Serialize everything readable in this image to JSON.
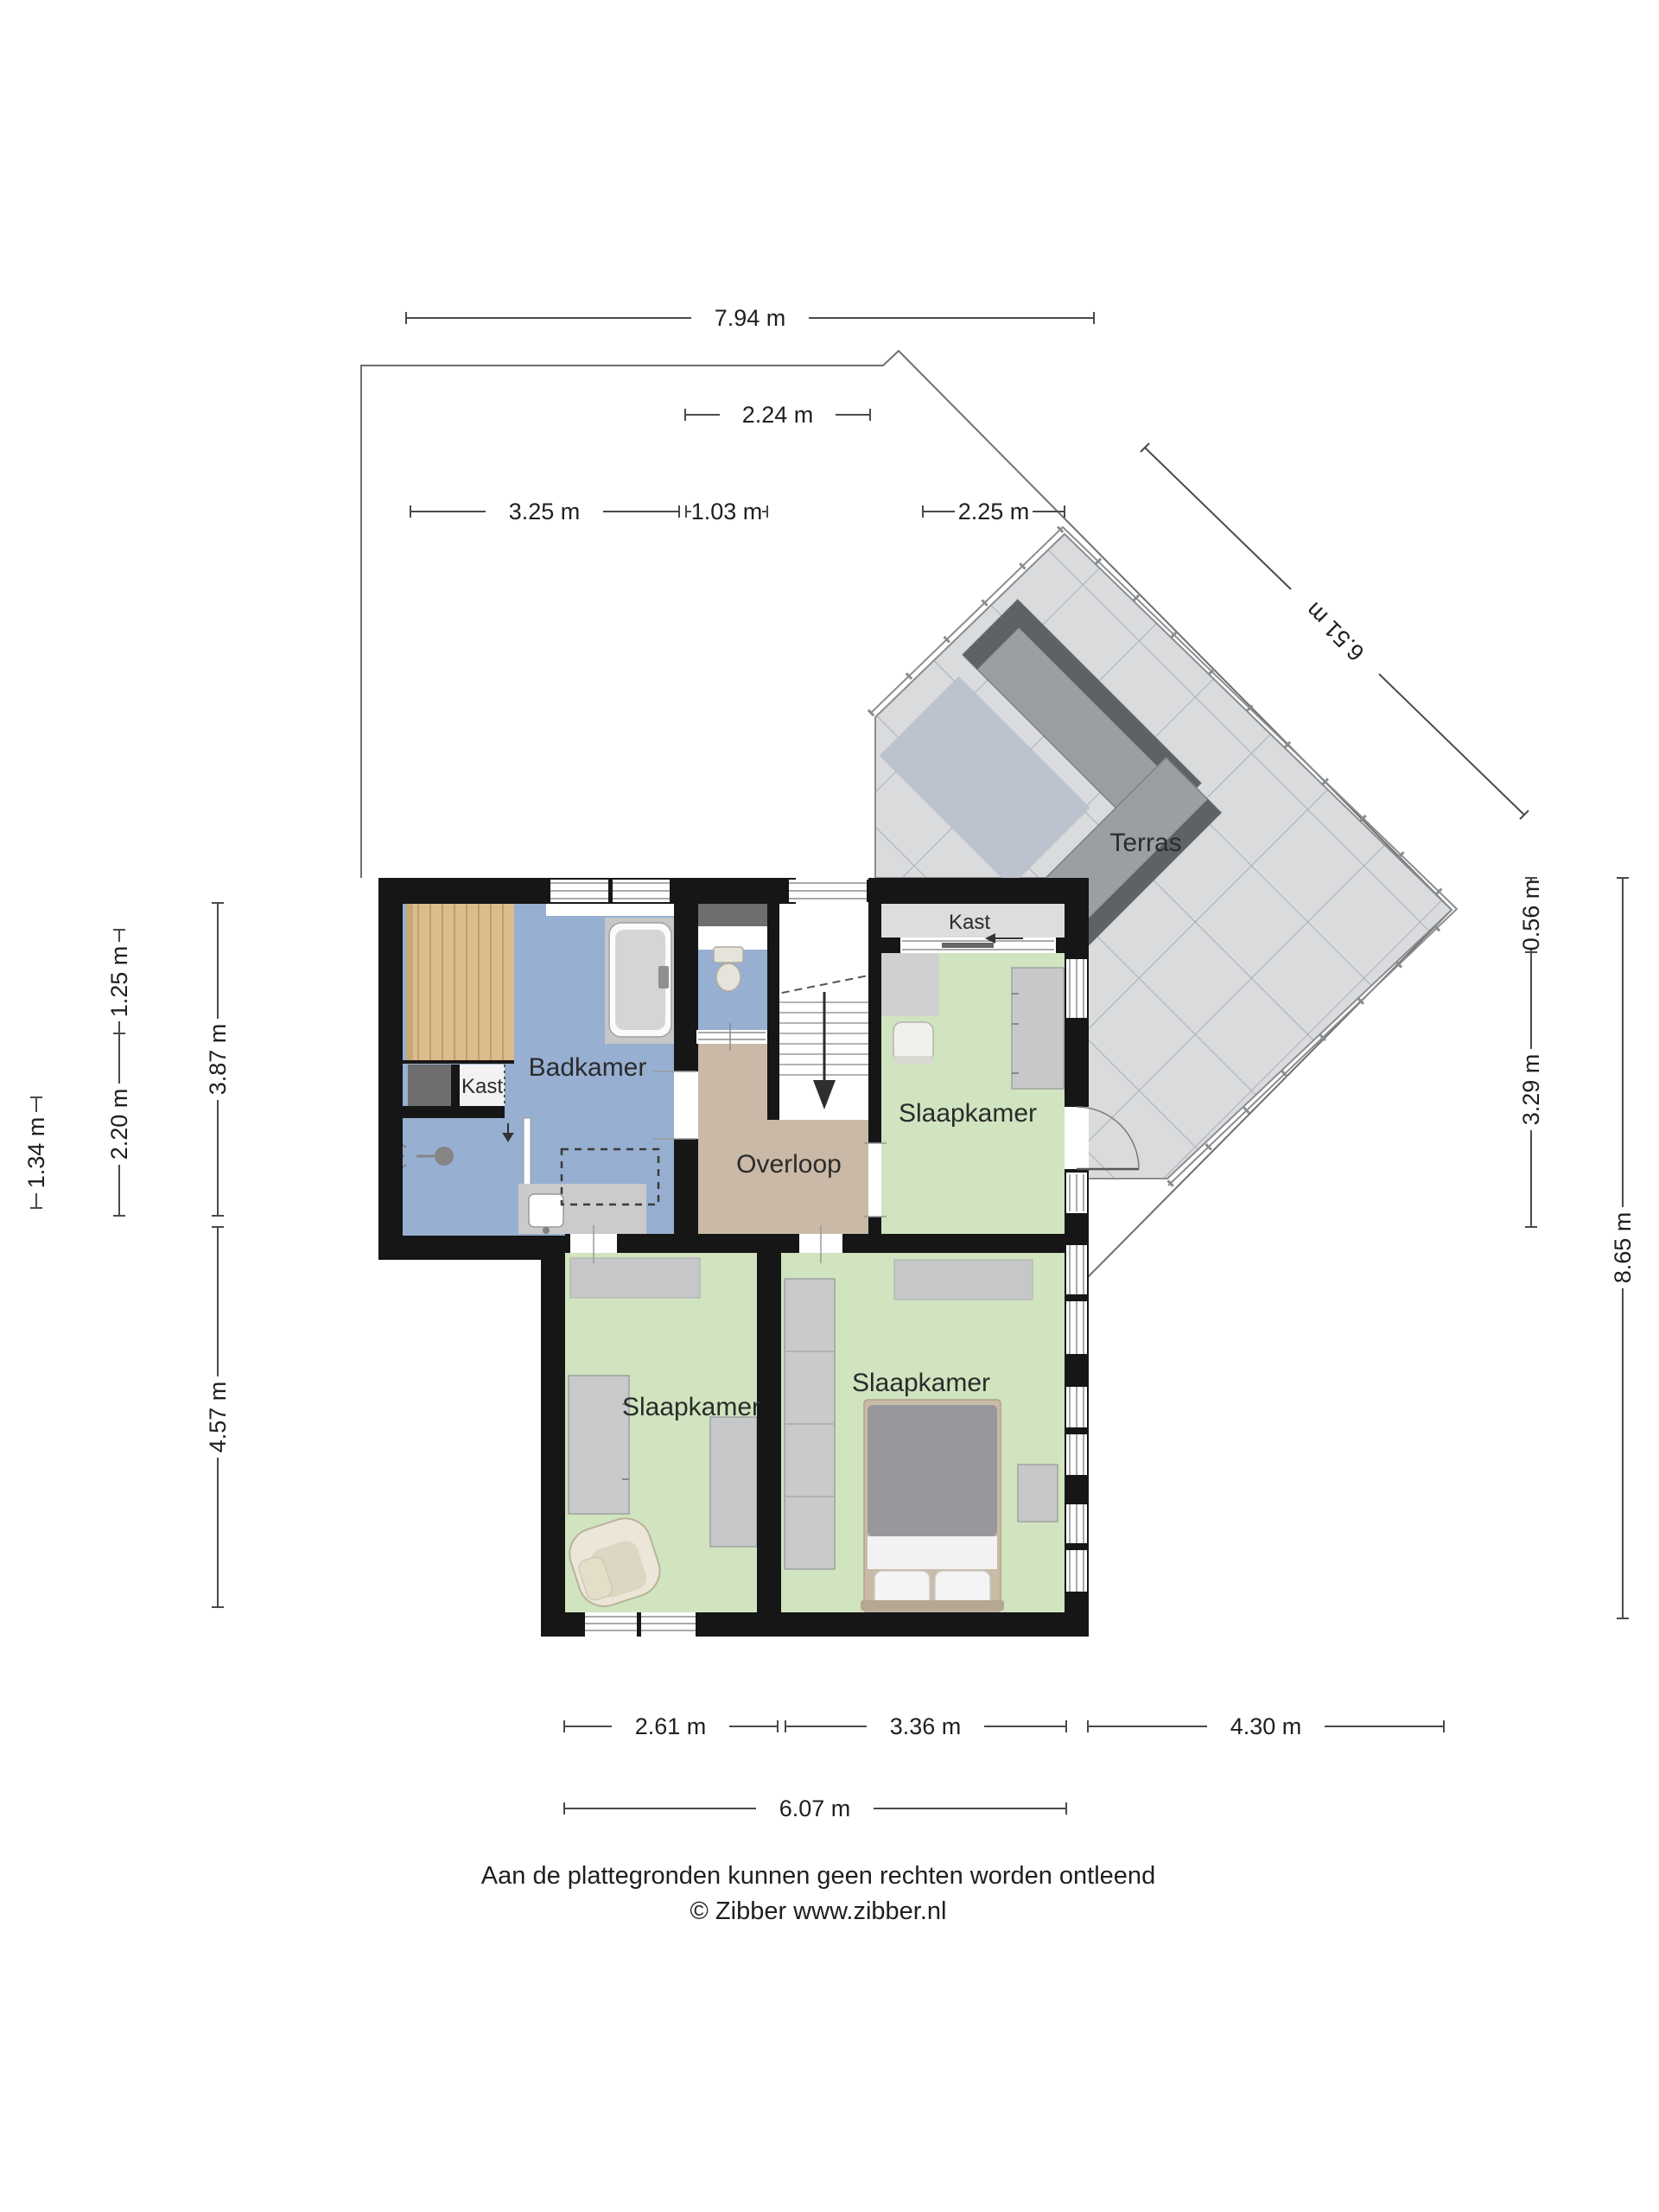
{
  "rooms": {
    "terras": "Terras",
    "kast_upper": "Kast",
    "slaapkamer_upper": "Slaapkamer",
    "badkamer": "Badkamer",
    "kast_badkamer": "Kast",
    "overloop": "Overloop",
    "slaapkamer_left": "Slaapkamer",
    "slaapkamer_right": "Slaapkamer"
  },
  "dimensions": {
    "top_total": "7.94 m",
    "top_block": "2.24 m",
    "top_seg1": "3.25 m",
    "top_seg2": "1.03 m",
    "top_seg3": "2.25 m",
    "diag": "6.51 m",
    "left_a": "1.25 m",
    "left_b": "2.20 m",
    "left_c": "3.87 m",
    "left_d": "1.34 m",
    "left_e": "4.57 m",
    "right_a": "0.56 m",
    "right_b": "3.29 m",
    "right_c": "8.65 m",
    "bottom_a": "2.61 m",
    "bottom_b": "3.36 m",
    "bottom_c": "4.30 m",
    "bottom_total": "6.07 m"
  },
  "footer": {
    "line1": "Aan de plattegronden kunnen geen rechten worden ontleend",
    "line2": "© Zibber www.zibber.nl"
  },
  "colors": {
    "wall": "#161616",
    "bath_blue": "#97afd1",
    "bedroom_green": "#cfe4bf",
    "landing_tan": "#c9b9a6",
    "closet_gray": "#dddddd",
    "tile_gray": "#d9dbdd",
    "tile_line": "#abaeb1",
    "wood": "#dcbb8d",
    "duct_gray": "#6e6e6e",
    "furniture_gray": "#c6c7c9",
    "dim_line": "#4a4a4a"
  }
}
